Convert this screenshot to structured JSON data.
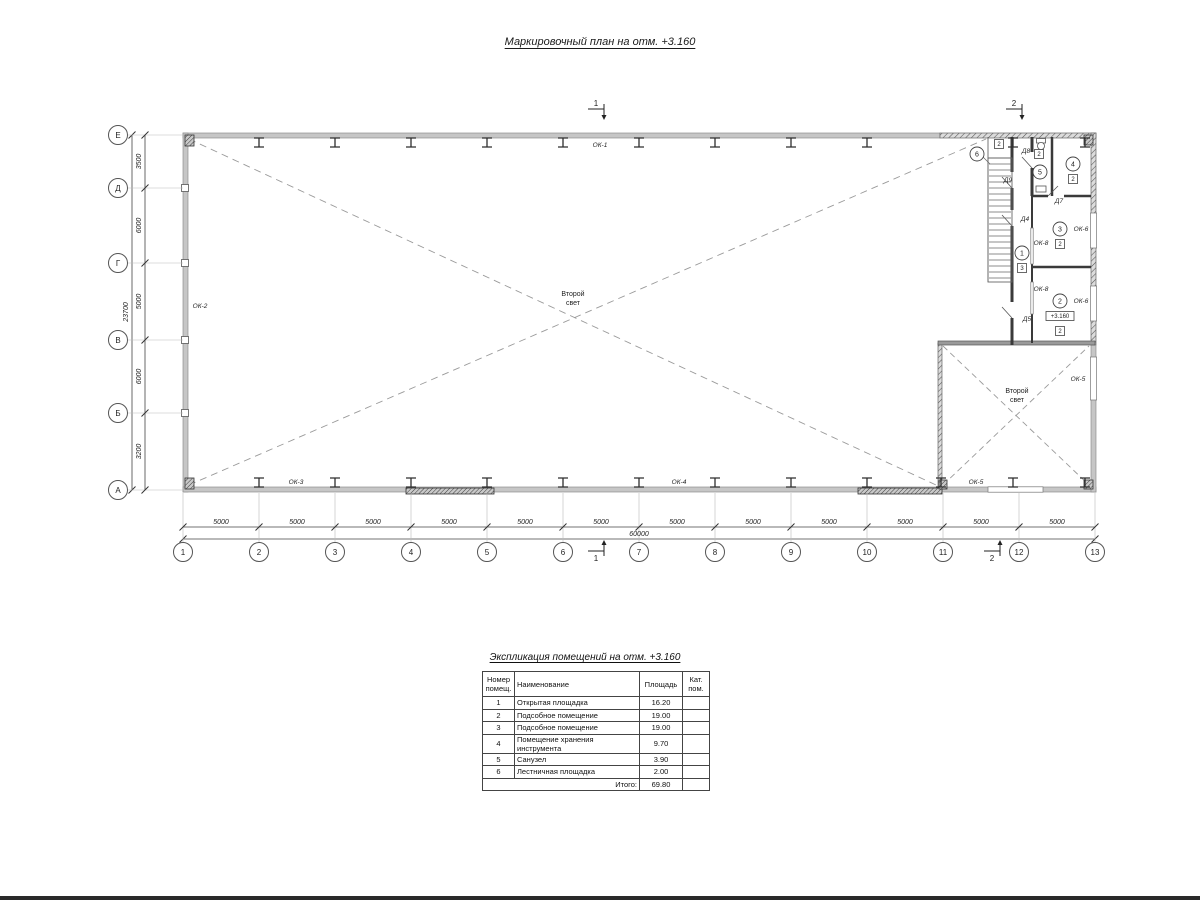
{
  "sheet": {
    "title": "Маркировочный план на отм. +3.160"
  },
  "axes": {
    "cols": {
      "labels": [
        "1",
        "2",
        "3",
        "4",
        "5",
        "6",
        "7",
        "8",
        "9",
        "10",
        "11",
        "12",
        "13"
      ],
      "dim_labels": [
        "5000",
        "5000",
        "5000",
        "5000",
        "5000",
        "5000",
        "5000",
        "5000",
        "5000",
        "5000",
        "5000",
        "5000"
      ],
      "total_label": "60000"
    },
    "rows": {
      "labels": [
        "Е",
        "Д",
        "Г",
        "В",
        "Б",
        "А"
      ],
      "dim_labels": [
        "3500",
        "6000",
        "5000",
        "6000",
        "3200"
      ],
      "total_label": "23700"
    }
  },
  "plan": {
    "window_labels": [
      {
        "t": "ОК-1",
        "x": 600,
        "y": 147
      },
      {
        "t": "ОК-2",
        "x": 200,
        "y": 308
      },
      {
        "t": "ОК-3",
        "x": 296,
        "y": 484
      },
      {
        "t": "ОК-4",
        "x": 679,
        "y": 484
      },
      {
        "t": "ОК-5",
        "x": 976,
        "y": 484
      },
      {
        "t": "ОК-5",
        "x": 1078,
        "y": 381
      },
      {
        "t": "ОК-6",
        "x": 1081,
        "y": 231
      },
      {
        "t": "ОК-6",
        "x": 1081,
        "y": 303
      },
      {
        "t": "ОК-8",
        "x": 1041,
        "y": 245
      },
      {
        "t": "ОК-8",
        "x": 1041,
        "y": 291
      }
    ],
    "door_labels": [
      {
        "t": "Д8",
        "x": 1026,
        "y": 153
      },
      {
        "t": "Д9",
        "x": 1008,
        "y": 182
      },
      {
        "t": "Д7",
        "x": 1059,
        "y": 203
      },
      {
        "t": "Д4",
        "x": 1025,
        "y": 221
      },
      {
        "t": "Д5",
        "x": 1027,
        "y": 321
      }
    ],
    "room_markers": [
      {
        "n": "6",
        "x": 977,
        "y": 154,
        "badge": "2",
        "bx": 999,
        "by": 144
      },
      {
        "n": "5",
        "x": 1040,
        "y": 172,
        "badge": "2",
        "bx": 1039,
        "by": 154
      },
      {
        "n": "4",
        "x": 1073,
        "y": 164,
        "badge": "2",
        "bx": 1073,
        "by": 179
      },
      {
        "n": "3",
        "x": 1060,
        "y": 229,
        "badge": "2",
        "bx": 1060,
        "by": 244
      },
      {
        "n": "2",
        "x": 1060,
        "y": 301,
        "badge": "2",
        "bx": 1060,
        "by": 331,
        "elev": "+3.160",
        "ex": 1060,
        "ey": 316
      },
      {
        "n": "1",
        "x": 1022,
        "y": 253,
        "badge": "3",
        "bx": 1022,
        "by": 268
      }
    ],
    "void_labels": [
      {
        "l1": "Второй",
        "l2": "свет",
        "x": 573,
        "y": 296
      },
      {
        "l1": "Второй",
        "l2": "свет",
        "x": 1017,
        "y": 393
      }
    ],
    "section_markers": [
      {
        "label": "1",
        "x": 604,
        "y": 109,
        "pos": "top"
      },
      {
        "label": "2",
        "x": 1022,
        "y": 109,
        "pos": "top"
      },
      {
        "label": "1",
        "x": 604,
        "y": 551,
        "pos": "bottom"
      },
      {
        "label": "2",
        "x": 1000,
        "y": 551,
        "pos": "bottom"
      }
    ]
  },
  "table": {
    "title": "Экспликация помещений на отм. +3.160",
    "headers": [
      "Номер\nпомещ.",
      "Наименование",
      "Площадь",
      "Кат.\nпом."
    ],
    "rows": [
      [
        "1",
        "Открытая площадка",
        "16.20",
        ""
      ],
      [
        "2",
        "Подсобное помещение",
        "19.00",
        ""
      ],
      [
        "3",
        "Подсобное помещение",
        "19.00",
        ""
      ],
      [
        "4",
        "Помещение хранения инструмента",
        "9.70",
        ""
      ],
      [
        "5",
        "Санузел",
        "3.90",
        ""
      ],
      [
        "6",
        "Лестничная площадка",
        "2.00",
        ""
      ]
    ],
    "total_label": "Итого:",
    "total_value": "69.80"
  }
}
